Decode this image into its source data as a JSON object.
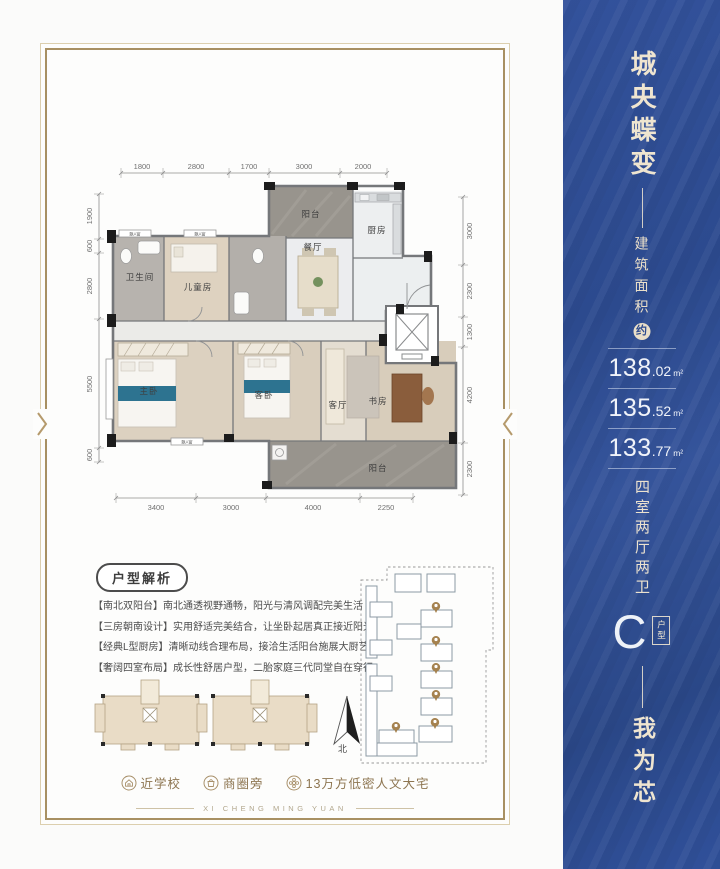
{
  "floor_plan": {
    "dims_top": [
      "1800",
      "2800",
      "1700",
      "3000",
      "2000"
    ],
    "dims_left": [
      "1900",
      "600",
      "2800",
      "5500",
      "600"
    ],
    "dims_right": [
      "3000",
      "2300",
      "1300",
      "4200",
      "2300"
    ],
    "dims_bottom": [
      "3400",
      "3000",
      "4000",
      "2250"
    ],
    "rooms": {
      "balcony_top": "阳台",
      "kitchen": "厨房",
      "dining": "餐厅",
      "bathroom": "卫生间",
      "kids_room": "儿童房",
      "master_bedroom": "主卧",
      "guest_bedroom": "客卧",
      "living_room": "客厅",
      "study": "书房",
      "balcony_bottom": "阳台",
      "bay_window": "飘A窗"
    }
  },
  "analysis": {
    "title": "户型解析",
    "bullets": [
      "【南北双阳台】南北通透视野通畅，阳光与清风调配完美生活",
      "【三房朝南设计】实用舒适完美结合，让坐卧起居真正接近阳光",
      "【经典L型厨房】清晰动线合理布局，接洽生活阳台施展大厨艺",
      "【奢阔四室布局】成长性舒居户型，二胎家庭三代同堂自在穿行"
    ]
  },
  "compass": {
    "north_label": "北"
  },
  "features": [
    {
      "label": "近学校"
    },
    {
      "label": "商圈旁"
    },
    {
      "label": "13万方低密人文大宅"
    }
  ],
  "footer": {
    "caption": "XI CHENG MING YUAN"
  },
  "side_panel": {
    "slogan_top": "城央蝶变",
    "area_title": "建筑面积",
    "area_approx": "约",
    "areas": [
      {
        "int": "138",
        "dec": ".02",
        "unit": "m²"
      },
      {
        "int": "135",
        "dec": ".52",
        "unit": "m²"
      },
      {
        "int": "133",
        "dec": ".77",
        "unit": "m²"
      }
    ],
    "layout_text": "四室两厅两卫",
    "unit_type_letter": "C",
    "unit_type_label": "户型",
    "slogan_bottom": "我为芯"
  },
  "colors": {
    "panel_blue": "#2c4a8e",
    "gold": "#a89062",
    "cream": "#efe5d0",
    "pin": "#a5824f"
  }
}
